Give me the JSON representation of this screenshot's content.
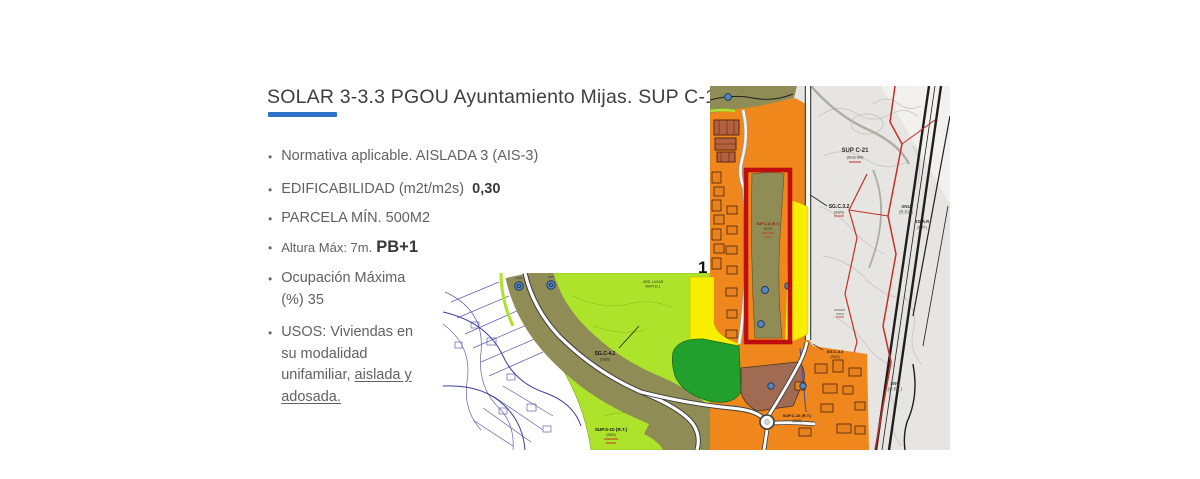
{
  "slide": {
    "title": "SOLAR 3-3.3 PGOU Ayuntamiento Mijas. SUP C-10 (R.T.)",
    "accent_color": "#2E73C8",
    "bullets": {
      "b1": "Normativa aplicable. AISLADA 3 (AIS-3)",
      "b2_label": "EDIFICABILIDAD (m2t/m2s)",
      "b2_value": "0,30",
      "b3": "PARCELA MÍN. 500M2",
      "b4_label": "Altura Máx: 7m.",
      "b4_value": "PB+1",
      "b5_line1": "Ocupación Máxima",
      "b5_line2": "(%) 35",
      "b6_line1": "USOS: Viviendas en",
      "b6_line2": "su modalidad",
      "b6_line3_normal": "unifamiliar,",
      "b6_line3_underlined": "aislada y",
      "b6_line4_underlined": "adosada."
    }
  },
  "map": {
    "marker": "1",
    "labels": {
      "sup_c21": "SUP C-21",
      "sup_c21_sub": "(SUS-SR)",
      "sg_c32": "SG.C.3.2",
      "sg_c32_sub": "(SUS)",
      "snu_1": "SNU",
      "snu_1_sub": "(R.P.L.)",
      "sg_ar": "SG.A.R",
      "sg_ar_sub": "(R.P.)",
      "snu_2": "SNU",
      "snu_2_sub": "(R.P.L.)",
      "parcel_strip": "SUP C-10 (R.T.)",
      "parcel_strip_sub": "(SUS)",
      "sg_c42": "SG.C-4.2",
      "sg_c42_sub": "(SUS)",
      "sup_s10": "SUP.S-10 (R.T.)",
      "sup_s10_sub": "(SUS)",
      "urb_lagar_1": "URB. LAGAR",
      "urb_lagar_2": "MARTELL",
      "sup_c10_bottom": "SUP.C-10 (R.T.)",
      "sup_c10_bottom_sub": "(SUS)",
      "sg_c33": "SG.C-3.3",
      "sg_c33_sub": "(SUS)"
    },
    "colors": {
      "orange_zone": "#F0871C",
      "yellow_zone": "#F8EE00",
      "lime_zone": "#ADE32A",
      "olive_zone": "#8F8C55",
      "dark_green_zone": "#21A02D",
      "brown_zone": "#A16A52",
      "gray_zone": "#E7E5E1",
      "building_complex": "#B4613F",
      "parcel_outline_red": "#C00D0D",
      "boundary_red": "#C2302B"
    }
  }
}
